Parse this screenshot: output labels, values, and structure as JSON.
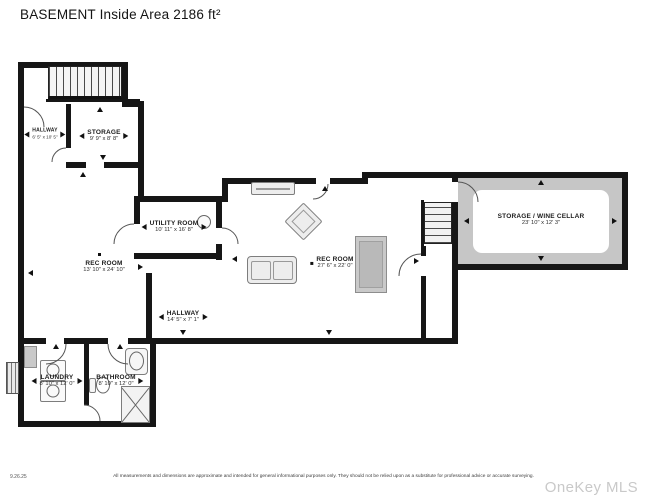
{
  "title": "BASEMENT Inside Area 2186 ft²",
  "rooms": [
    {
      "id": "hallway-upper",
      "name": "HALLWAY",
      "dims": "6' 5\" x 10' 5\""
    },
    {
      "id": "storage",
      "name": "STORAGE",
      "dims": "9' 9\" x 8' 8\""
    },
    {
      "id": "utility-room",
      "name": "UTILITY ROOM",
      "dims": "10' 11\" x 16' 8\""
    },
    {
      "id": "rec-room-left",
      "name": "REC ROOM",
      "dims": "13' 10\" x 24' 10\""
    },
    {
      "id": "rec-room-main",
      "name": "REC ROOM",
      "dims": "27' 6\" x 22' 0\""
    },
    {
      "id": "storage-wine-cellar",
      "name": "STORAGE / WINE CELLAR",
      "dims": "23' 10\" x 12' 3\""
    },
    {
      "id": "hallway-lower",
      "name": "HALLWAY",
      "dims": "14' 5\" x 7' 1\""
    },
    {
      "id": "laundry",
      "name": "LAUNDRY",
      "dims": "8' 10\" x 12' 0\""
    },
    {
      "id": "bathroom",
      "name": "BATHROOM",
      "dims": "8' 10\" x 12' 0\""
    }
  ],
  "footer": {
    "date": "9.26.25",
    "disclaimer": "All measurements and dimensions are approximate and intended for general informational purposes only. They should not be relied upon as a substitute for professional advice or accurate surveying.",
    "watermark": "OneKey MLS"
  },
  "colors": {
    "wall": "#161616",
    "cellar_shade": "#c6c6c6",
    "watermark": "#c9c9c9"
  }
}
